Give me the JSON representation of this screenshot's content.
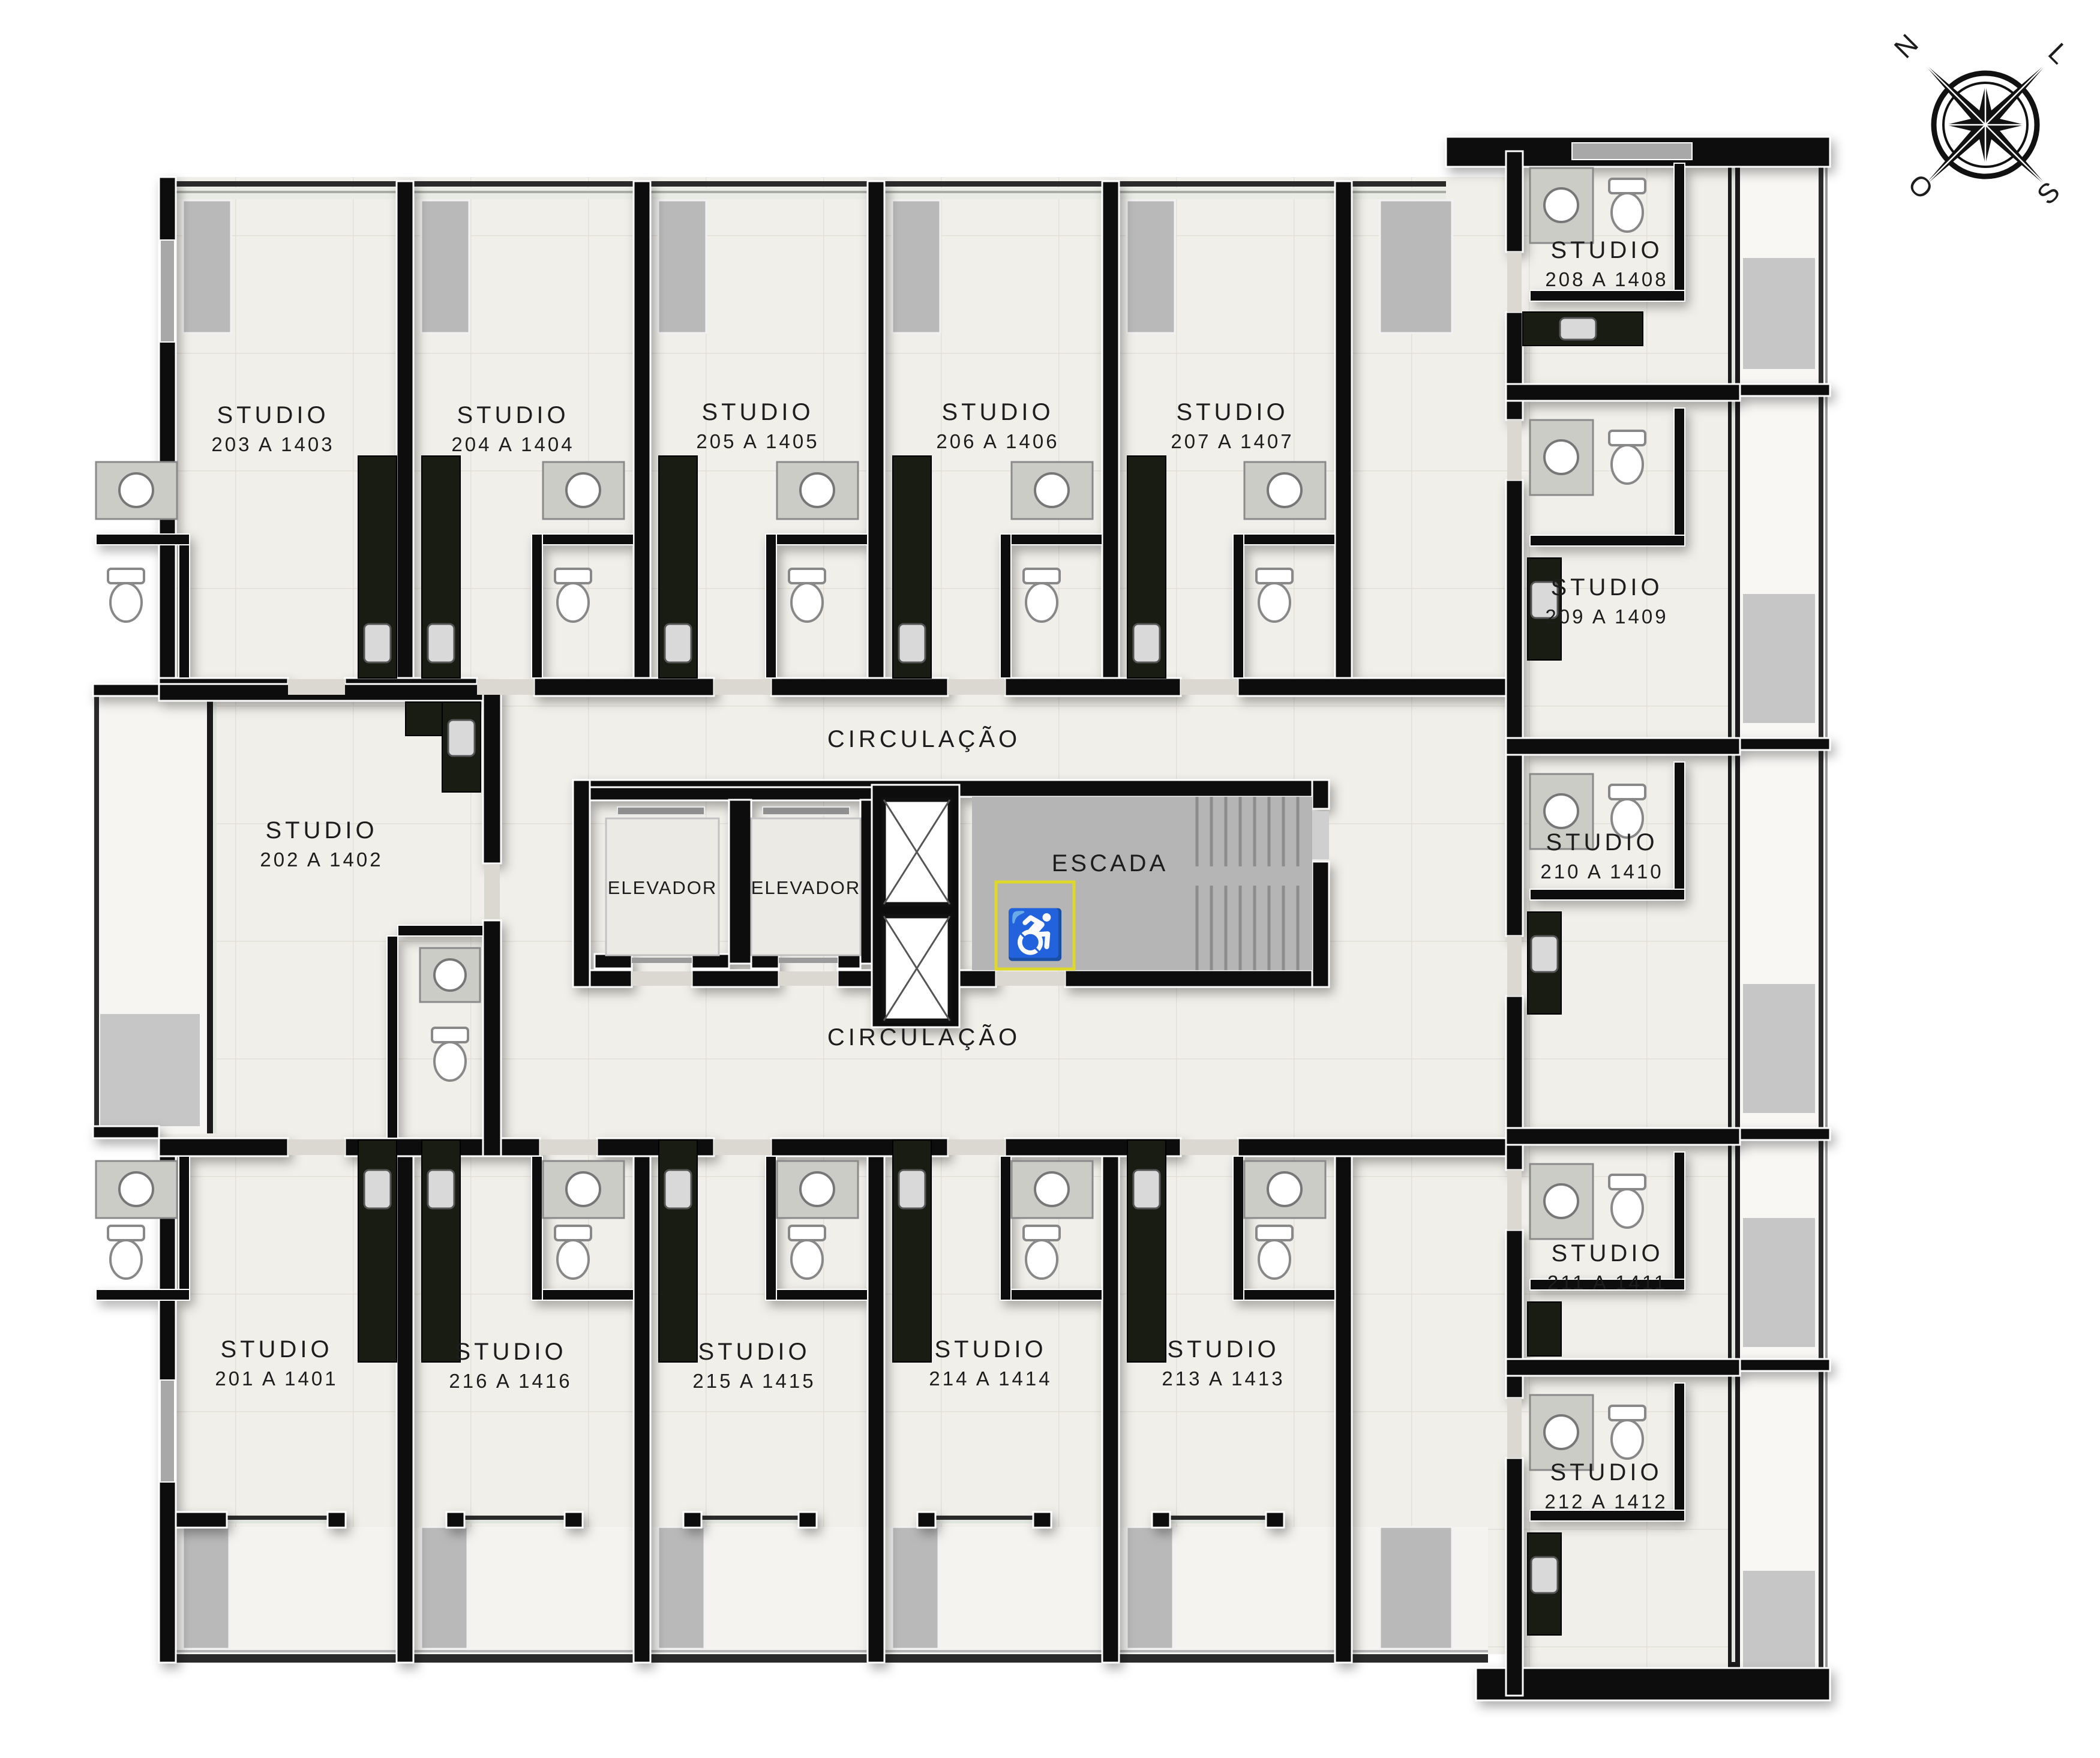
{
  "plan": {
    "circulation_top": "CIRCULAÇÃO",
    "circulation_bottom": "CIRCULAÇÃO",
    "core": {
      "elevator_left": "ELEVADOR",
      "elevator_right": "ELEVADOR",
      "stairs": "ESCADA"
    },
    "compass": {
      "north": "N",
      "east": "L",
      "south": "S",
      "west": "O"
    },
    "icons": {
      "wheelchair": "♿"
    },
    "rooms": {
      "r201": {
        "type": "STUDIO",
        "units": "201 A 1401"
      },
      "r202": {
        "type": "STUDIO",
        "units": "202 A 1402"
      },
      "r203": {
        "type": "STUDIO",
        "units": "203 A 1403"
      },
      "r204": {
        "type": "STUDIO",
        "units": "204 A 1404"
      },
      "r205": {
        "type": "STUDIO",
        "units": "205 A 1405"
      },
      "r206": {
        "type": "STUDIO",
        "units": "206 A 1406"
      },
      "r207": {
        "type": "STUDIO",
        "units": "207 A 1407"
      },
      "r208": {
        "type": "STUDIO",
        "units": "208 A 1408"
      },
      "r209": {
        "type": "STUDIO",
        "units": "209 A 1409"
      },
      "r210": {
        "type": "STUDIO",
        "units": "210 A 1410"
      },
      "r211": {
        "type": "STUDIO",
        "units": "211 A 1411"
      },
      "r212": {
        "type": "STUDIO",
        "units": "212 A 1412"
      },
      "r213": {
        "type": "STUDIO",
        "units": "213 A 1413"
      },
      "r214": {
        "type": "STUDIO",
        "units": "214 A 1414"
      },
      "r215": {
        "type": "STUDIO",
        "units": "215 A 1415"
      },
      "r216": {
        "type": "STUDIO",
        "units": "216 A 1416"
      }
    },
    "colors": {
      "wall": "#0b0b0b",
      "floor": "#f1efe9",
      "stair_gray": "#b5b5b5",
      "granite": "#191c12",
      "accessible_yellow": "#ddd829"
    }
  }
}
